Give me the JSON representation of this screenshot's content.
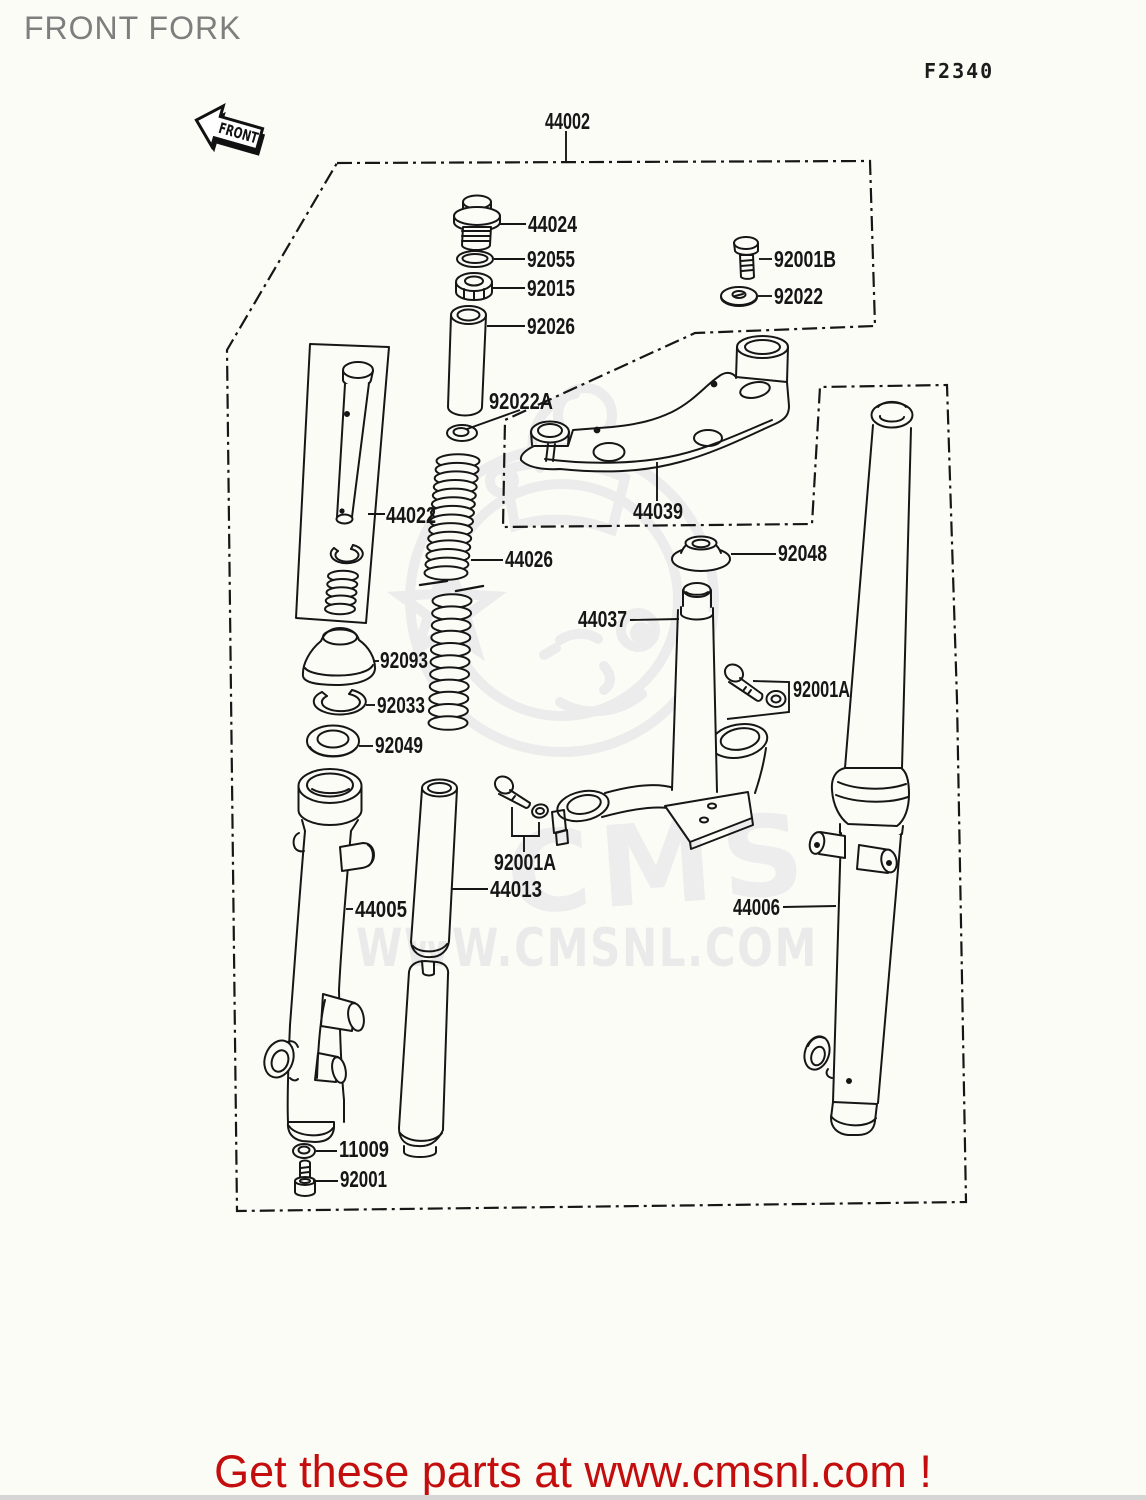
{
  "page": {
    "title": "FRONT FORK",
    "diagram_code": "F2340",
    "footer_text": "Get these parts at www.cmsnl.com !",
    "footer_color": "#c40e0e",
    "background": "#fcfcf7",
    "line_color": "#161616"
  },
  "watermark": {
    "brand": "CMS",
    "url_text": "WWW.CMSNL.COM",
    "color": "#ececec"
  },
  "front_arrow": {
    "label": "FRONT"
  },
  "diagram": {
    "part_labels": [
      {
        "ref": "44002",
        "x": 545,
        "y": 129,
        "len": 45
      },
      {
        "ref": "44024",
        "x": 528,
        "y": 232,
        "len": 49
      },
      {
        "ref": "92055",
        "x": 527,
        "y": 267,
        "len": 48
      },
      {
        "ref": "92015",
        "x": 527,
        "y": 296,
        "len": 48
      },
      {
        "ref": "92026",
        "x": 527,
        "y": 334,
        "len": 48
      },
      {
        "ref": "92001B",
        "x": 774,
        "y": 267,
        "len": 62
      },
      {
        "ref": "92022",
        "x": 774,
        "y": 304,
        "len": 49
      },
      {
        "ref": "92022A",
        "x": 489,
        "y": 409,
        "len": 64
      },
      {
        "ref": "44022",
        "x": 386,
        "y": 523,
        "len": 50
      },
      {
        "ref": "44039",
        "x": 633,
        "y": 519,
        "len": 50
      },
      {
        "ref": "44026",
        "x": 505,
        "y": 567,
        "len": 48
      },
      {
        "ref": "92048",
        "x": 778,
        "y": 561,
        "len": 49
      },
      {
        "ref": "44037",
        "x": 578,
        "y": 627,
        "len": 49
      },
      {
        "ref": "92001A",
        "x": 793,
        "y": 697,
        "len": 57
      },
      {
        "ref": "92093",
        "x": 380,
        "y": 668,
        "len": 48
      },
      {
        "ref": "92033",
        "x": 377,
        "y": 713,
        "len": 48
      },
      {
        "ref": "92049",
        "x": 375,
        "y": 753,
        "len": 48
      },
      {
        "ref": "92001A",
        "x": 494,
        "y": 870,
        "len": 62
      },
      {
        "ref": "44013",
        "x": 490,
        "y": 897,
        "len": 52
      },
      {
        "ref": "44005",
        "x": 355,
        "y": 917,
        "len": 52
      },
      {
        "ref": "44006",
        "x": 733,
        "y": 915,
        "len": 47
      },
      {
        "ref": "11009",
        "x": 339,
        "y": 1157,
        "len": 50
      },
      {
        "ref": "92001",
        "x": 340,
        "y": 1187,
        "len": 47
      }
    ]
  }
}
